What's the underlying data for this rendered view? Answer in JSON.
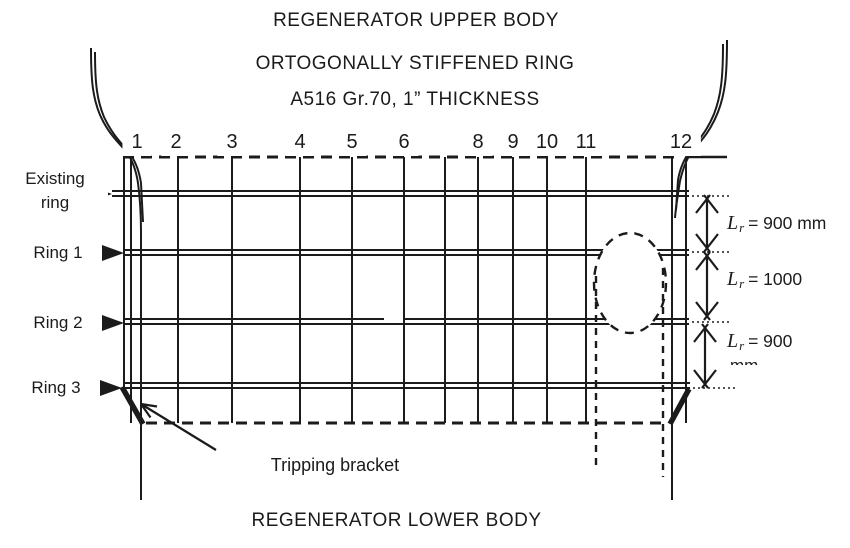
{
  "header": {
    "title": "REGENERATOR UPPER BODY",
    "subtitle_line1": "ORTOGONALLY STIFFENED RING",
    "subtitle_line2": "A516 Gr.70, 1” THICKNESS"
  },
  "footer": {
    "title": "REGENERATOR LOWER BODY"
  },
  "stiffener_numbers": [
    {
      "label": "1",
      "x": 137
    },
    {
      "label": "2",
      "x": 176
    },
    {
      "label": "3",
      "x": 232
    },
    {
      "label": "4",
      "x": 300
    },
    {
      "label": "5",
      "x": 352
    },
    {
      "label": "6",
      "x": 404
    },
    {
      "label": "8",
      "x": 478
    },
    {
      "label": "9",
      "x": 513
    },
    {
      "label": "10",
      "x": 547
    },
    {
      "label": "11",
      "x": 586
    },
    {
      "label": "12",
      "x": 681
    }
  ],
  "left_labels": {
    "existing_ring_line1": "Existing",
    "existing_ring_line2": "ring",
    "ring1": "Ring 1",
    "ring2": "Ring 2",
    "ring3": "Ring 3"
  },
  "dimensions": [
    {
      "symbol": "L",
      "subscript": "r",
      "value": "= 900 mm"
    },
    {
      "symbol": "L",
      "subscript": "r",
      "value": "= 1000"
    },
    {
      "symbol": "L",
      "subscript": "r",
      "value": "= 900",
      "clipped": "mm"
    }
  ],
  "annotations": {
    "tripping_bracket": "Tripping bracket"
  },
  "colors": {
    "line": "#1b1b1b",
    "background": "#ffffff"
  }
}
